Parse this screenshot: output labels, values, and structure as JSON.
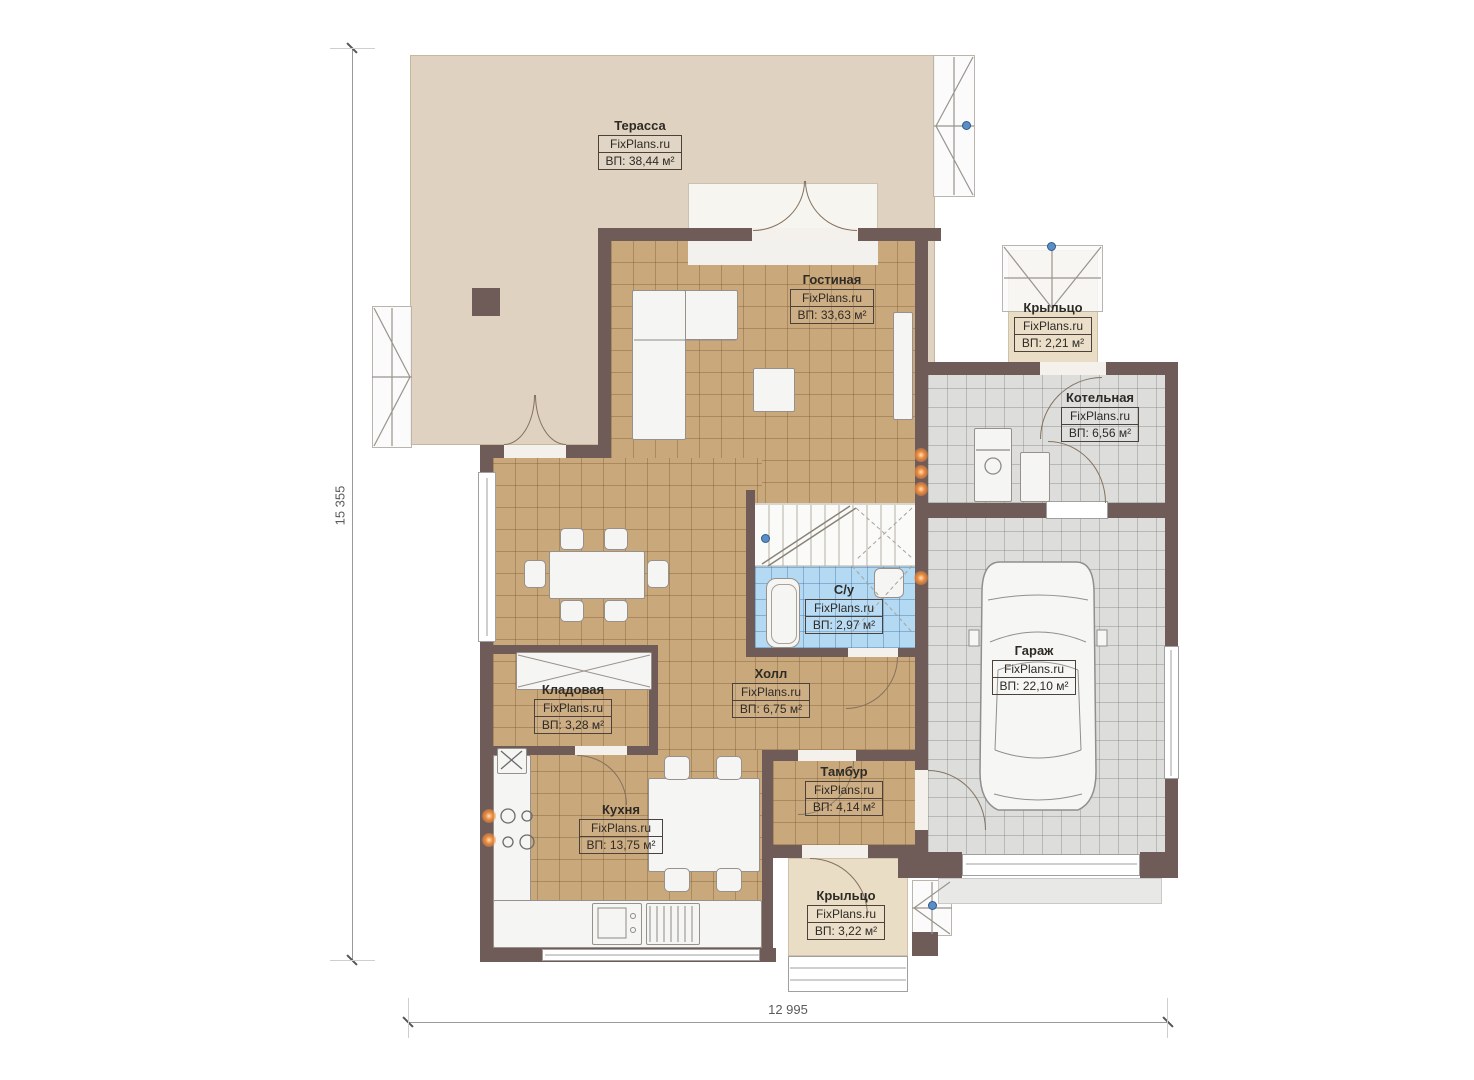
{
  "watermark": "FixPlans.ru",
  "dimensions": {
    "height_mm": "15 355",
    "width_mm": "12 995"
  },
  "rooms": [
    {
      "name": "Терасса",
      "site": "FixPlans.ru",
      "area": "ВП: 38,44 м²"
    },
    {
      "name": "Гостиная",
      "site": "FixPlans.ru",
      "area": "ВП: 33,63 м²"
    },
    {
      "name": "Крыльцо",
      "site": "FixPlans.ru",
      "area": "ВП: 2,21 м²"
    },
    {
      "name": "Котельная",
      "site": "FixPlans.ru",
      "area": "ВП: 6,56 м²"
    },
    {
      "name": "С/у",
      "site": "FixPlans.ru",
      "area": "ВП: 2,97 м²"
    },
    {
      "name": "Гараж",
      "site": "FixPlans.ru",
      "area": "ВП: 22,10 м²"
    },
    {
      "name": "Кладовая",
      "site": "FixPlans.ru",
      "area": "ВП: 3,28 м²"
    },
    {
      "name": "Холл",
      "site": "FixPlans.ru",
      "area": "ВП: 6,75 м²"
    },
    {
      "name": "Тамбур",
      "site": "FixPlans.ru",
      "area": "ВП: 4,14 м²"
    },
    {
      "name": "Кухня",
      "site": "FixPlans.ru",
      "area": "ВП: 13,75 м²"
    },
    {
      "name": "Крыльцо",
      "site": "FixPlans.ru",
      "area": "ВП: 3,22 м²"
    }
  ],
  "colors": {
    "wall": "#6F5B58",
    "floor_tan": "#C9A87B",
    "floor_gray": "#DDDDDB",
    "floor_blue": "#B3D9F3",
    "terrace": "#DFD2C0",
    "porch": "#EADDC5",
    "accent_orange": "#EF8D3D",
    "node_blue": "#5B8EC4"
  }
}
